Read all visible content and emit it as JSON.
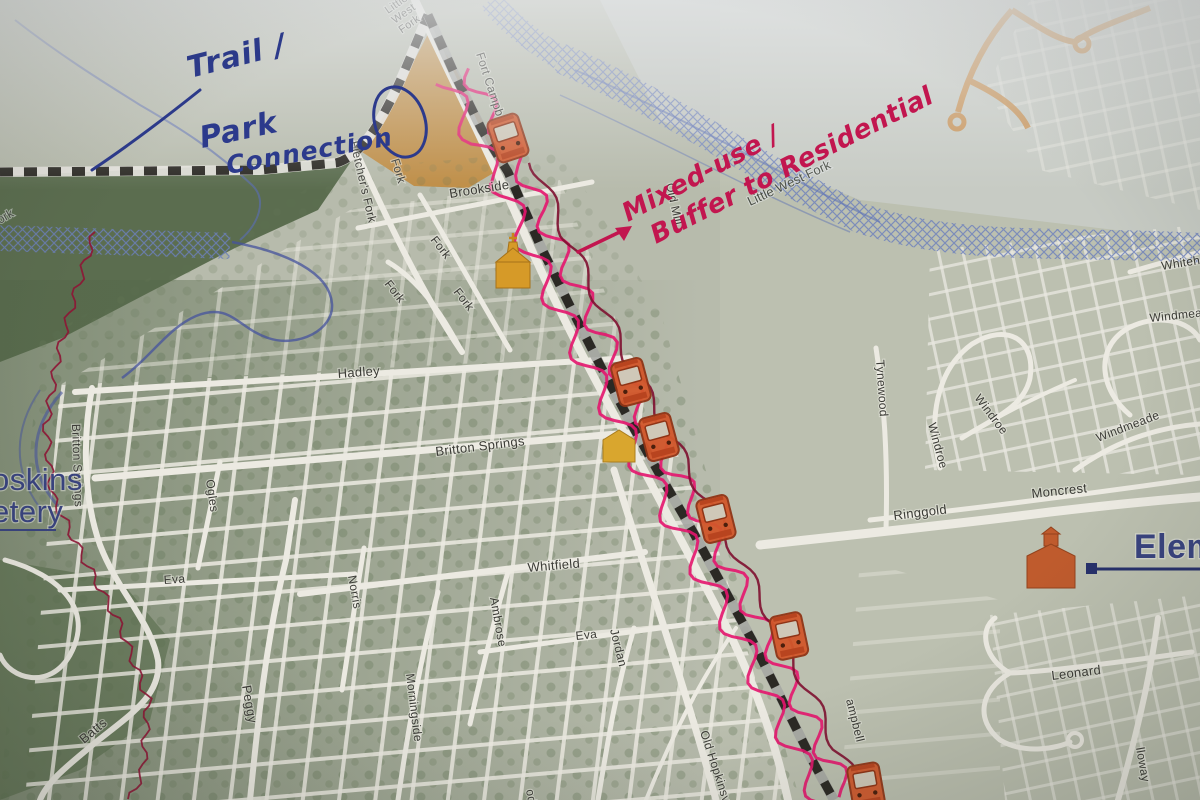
{
  "map": {
    "street_labels": [
      {
        "text": "Little West Fork",
        "x": 388,
        "y": 14,
        "r": -35,
        "s": 11,
        "c": "road",
        "st": true
      },
      {
        "text": "Fort Campb",
        "x": 476,
        "y": 54,
        "r": 72,
        "s": 12,
        "c": "road"
      },
      {
        "text": "Fletcher's Fork",
        "x": 350,
        "y": 142,
        "r": 77,
        "s": 12,
        "c": "road"
      },
      {
        "text": "Fork",
        "x": 391,
        "y": 160,
        "r": 73,
        "s": 12,
        "c": "road"
      },
      {
        "text": "Brookside",
        "x": 450,
        "y": 198,
        "r": -9,
        "s": 13,
        "c": "road"
      },
      {
        "text": "Old Mill",
        "x": 666,
        "y": 184,
        "r": 78,
        "s": 12,
        "c": "road"
      },
      {
        "text": "Little West Fork",
        "x": 750,
        "y": 206,
        "r": -25,
        "s": 13,
        "c": "water"
      },
      {
        "text": "ork",
        "x": 0,
        "y": 224,
        "r": -30,
        "s": 12,
        "c": "water"
      },
      {
        "text": "Fork",
        "x": 384,
        "y": 284,
        "r": 52,
        "s": 12,
        "c": "road"
      },
      {
        "text": "Fork",
        "x": 430,
        "y": 240,
        "r": 52,
        "s": 12,
        "c": "road"
      },
      {
        "text": "Fork",
        "x": 453,
        "y": 292,
        "r": 52,
        "s": 12,
        "c": "road"
      },
      {
        "text": "Whiteh",
        "x": 1162,
        "y": 270,
        "r": -9,
        "s": 12,
        "c": "road"
      },
      {
        "text": "Windmea",
        "x": 1150,
        "y": 322,
        "r": -6,
        "s": 12,
        "c": "road"
      },
      {
        "text": "Hadley",
        "x": 338,
        "y": 378,
        "r": -4,
        "s": 13,
        "c": "road"
      },
      {
        "text": "Tynewood",
        "x": 876,
        "y": 360,
        "r": 86,
        "s": 12,
        "c": "road"
      },
      {
        "text": "Windroe",
        "x": 974,
        "y": 398,
        "r": 53,
        "s": 12,
        "c": "road"
      },
      {
        "text": "Windroe",
        "x": 928,
        "y": 424,
        "r": 75,
        "s": 12,
        "c": "road"
      },
      {
        "text": "Windmeade",
        "x": 1098,
        "y": 442,
        "r": -21,
        "s": 12,
        "c": "road"
      },
      {
        "text": "Britton Springs",
        "x": 436,
        "y": 456,
        "r": -7,
        "s": 13,
        "c": "road"
      },
      {
        "text": "Britton Springs",
        "x": 72,
        "y": 424,
        "r": 88,
        "s": 12,
        "c": "road"
      },
      {
        "text": "Moncrest",
        "x": 1032,
        "y": 498,
        "r": -6,
        "s": 13,
        "c": "road"
      },
      {
        "text": "Ringgold",
        "x": 894,
        "y": 520,
        "r": -7,
        "s": 13,
        "c": "road"
      },
      {
        "text": "Ogles",
        "x": 206,
        "y": 480,
        "r": 82,
        "s": 12,
        "c": "road"
      },
      {
        "text": "Eva",
        "x": 164,
        "y": 584,
        "r": -4,
        "s": 12,
        "c": "road"
      },
      {
        "text": "Norris",
        "x": 348,
        "y": 576,
        "r": 80,
        "s": 12,
        "c": "road"
      },
      {
        "text": "Whitfield",
        "x": 528,
        "y": 572,
        "r": -5,
        "s": 13,
        "c": "road"
      },
      {
        "text": "Ambrose",
        "x": 490,
        "y": 598,
        "r": 80,
        "s": 12,
        "c": "road"
      },
      {
        "text": "Eva",
        "x": 576,
        "y": 640,
        "r": -6,
        "s": 12,
        "c": "road"
      },
      {
        "text": "Jordan",
        "x": 610,
        "y": 630,
        "r": 76,
        "s": 12,
        "c": "road"
      },
      {
        "text": "Morningside",
        "x": 406,
        "y": 674,
        "r": 83,
        "s": 12,
        "c": "road"
      },
      {
        "text": "Peggy",
        "x": 242,
        "y": 686,
        "r": 80,
        "s": 13,
        "c": "road"
      },
      {
        "text": "Batts",
        "x": 84,
        "y": 744,
        "r": -40,
        "s": 13,
        "c": "road"
      },
      {
        "text": "Old Hopkinsv",
        "x": 700,
        "y": 732,
        "r": 72,
        "s": 12,
        "c": "road"
      },
      {
        "text": "ampbell",
        "x": 846,
        "y": 700,
        "r": 76,
        "s": 12,
        "c": "road"
      },
      {
        "text": "Leonard",
        "x": 1052,
        "y": 680,
        "r": -7,
        "s": 13,
        "c": "road"
      },
      {
        "text": "lloway",
        "x": 1136,
        "y": 748,
        "r": 80,
        "s": 12,
        "c": "road"
      },
      {
        "text": "od",
        "x": 526,
        "y": 790,
        "r": 80,
        "s": 12,
        "c": "road"
      }
    ],
    "big_labels": [
      {
        "text": "oskins"
      },
      {
        "text": "etery"
      },
      {
        "text": "Eleme"
      }
    ],
    "annotations": {
      "blue_ink": {
        "color": "#2c3a8c",
        "text_lines": [
          "Trail /",
          "Park",
          "Connection"
        ]
      },
      "red_ink": {
        "color": "#c2164f",
        "text_lines": [
          "Mixed-use /",
          "Buffer to Residential"
        ],
        "has_arrow": true
      }
    },
    "icons": [
      {
        "name": "trolley-icon",
        "x": 508,
        "y": 138,
        "r": -18
      },
      {
        "name": "trolley-icon",
        "x": 631,
        "y": 382,
        "r": -15
      },
      {
        "name": "trolley-icon",
        "x": 659,
        "y": 437,
        "r": -15
      },
      {
        "name": "trolley-icon",
        "x": 716,
        "y": 519,
        "r": -14
      },
      {
        "name": "trolley-icon",
        "x": 789,
        "y": 636,
        "r": -12
      },
      {
        "name": "trolley-icon",
        "x": 866,
        "y": 786,
        "r": -10
      },
      {
        "name": "church-icon",
        "x": 513,
        "y": 264,
        "r": 0
      },
      {
        "name": "building-icon",
        "x": 619,
        "y": 446,
        "r": 0
      },
      {
        "name": "school-icon",
        "x": 1051,
        "y": 560,
        "r": 0
      }
    ],
    "colors": {
      "ink_blue": "#2c3a8c",
      "ink_red": "#c2164f",
      "rail_magenta": "#e4156e",
      "dark_red_line": "#7e1030",
      "proposed_road_orange": "#c98f4e",
      "landmark_orange": "#d2572b",
      "landmark_gold": "#d69a28",
      "navy_label": "#39437f",
      "railroad_black": "#2b2924"
    }
  }
}
